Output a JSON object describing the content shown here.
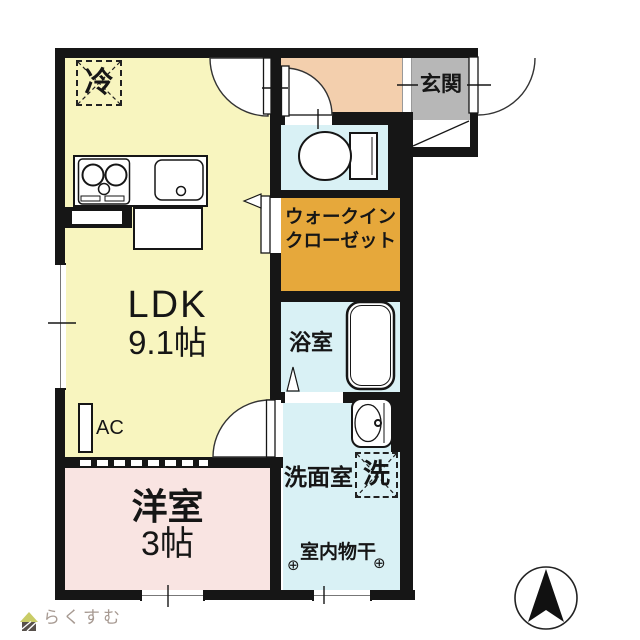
{
  "fp": {
    "rooms": {
      "ldk": {
        "label": "LDK",
        "size": "9.1帖",
        "color": "#F8F5BF"
      },
      "western": {
        "label": "洋室",
        "size": "3帖",
        "color": "#F9E4E2"
      },
      "wic": {
        "line1": "ウォークイン",
        "line2": "クローゼット",
        "color": "#E6A83B"
      },
      "bath": {
        "label": "浴室",
        "color": "#D9F1F5"
      },
      "wash": {
        "label": "洗面室",
        "color": "#D9F1F5"
      },
      "toilet": {
        "color": "#D9F1F5"
      },
      "hallway": {
        "color": "#F3CFAD"
      },
      "entrance": {
        "label": "玄関",
        "color": "#B7B7B7"
      }
    },
    "marks": {
      "fridge": "冷",
      "washer": "洗",
      "ac": "AC",
      "drying": "室内物干",
      "hook": "⊕"
    },
    "wall_color": "#161616"
  },
  "brand": {
    "logo": "らくすむ"
  }
}
